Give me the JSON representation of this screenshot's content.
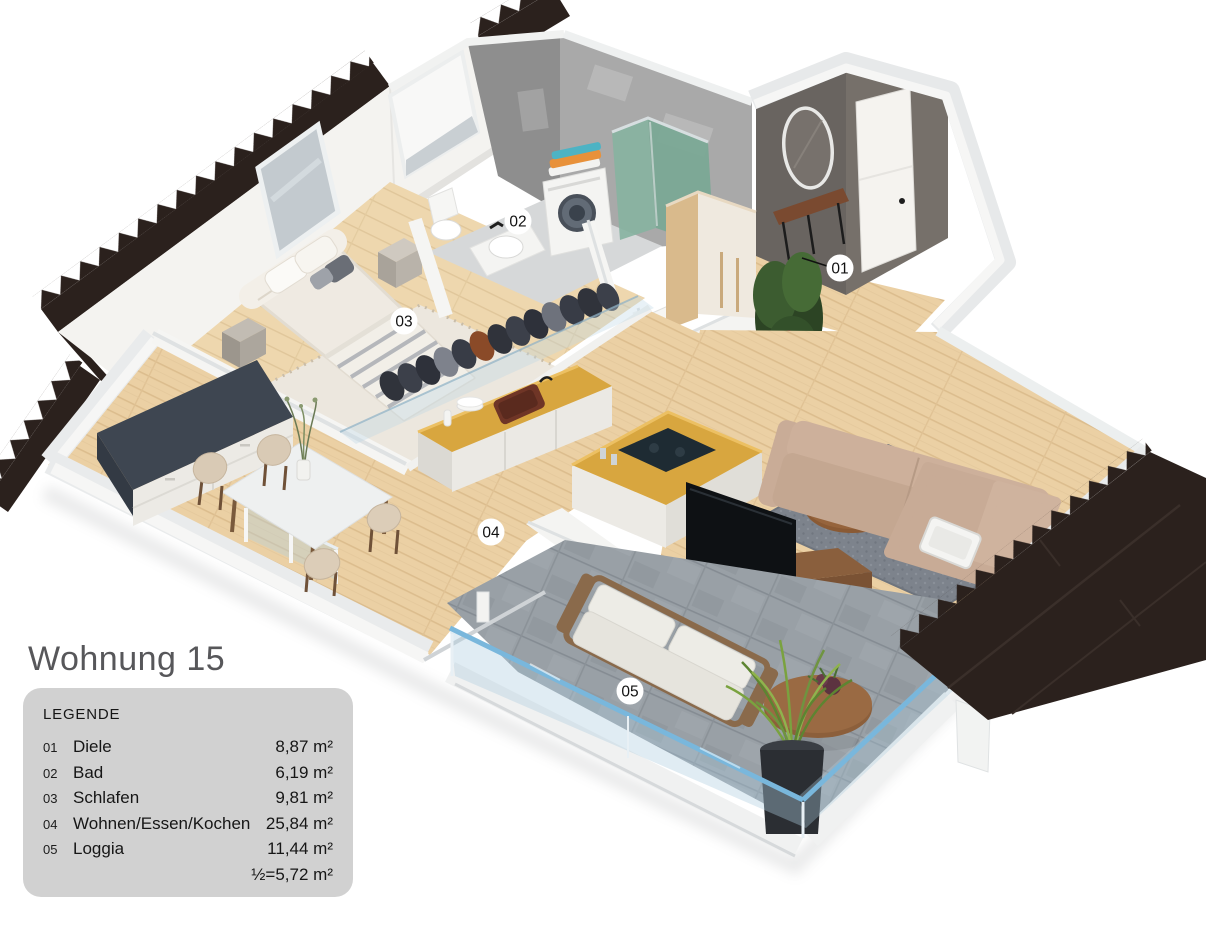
{
  "title": "Wohnung 15",
  "legend": {
    "heading": "LEGENDE",
    "rows": [
      {
        "num": "01",
        "name": "Diele",
        "area": "8,87 m²"
      },
      {
        "num": "02",
        "name": "Bad",
        "area": "6,19 m²"
      },
      {
        "num": "03",
        "name": "Schlafen",
        "area": "9,81 m²"
      },
      {
        "num": "04",
        "name": "Wohnen/Essen/Kochen",
        "area": "25,84 m²"
      },
      {
        "num": "05",
        "name": "Loggia",
        "area": "11,44 m²"
      }
    ],
    "half_note": "½=5,72 m²"
  },
  "plan": {
    "labels": [
      {
        "id": "01",
        "text": "01"
      },
      {
        "id": "02",
        "text": "02"
      },
      {
        "id": "03",
        "text": "03"
      },
      {
        "id": "04",
        "text": "04"
      },
      {
        "id": "05",
        "text": "05"
      }
    ]
  },
  "colors": {
    "legend_bg": "#d1d1d1",
    "title_text": "#57575a",
    "roof": "#2b211d",
    "wood_floor": "#ebd0a4",
    "loggia_tile": "#99a0a6",
    "accent_wall": "#696460",
    "concrete_wall": "#a9a9a9",
    "glass_rail": "#79b7dc",
    "kitchen_counter": "#d8a63f",
    "sofa": "#cdb09b"
  }
}
